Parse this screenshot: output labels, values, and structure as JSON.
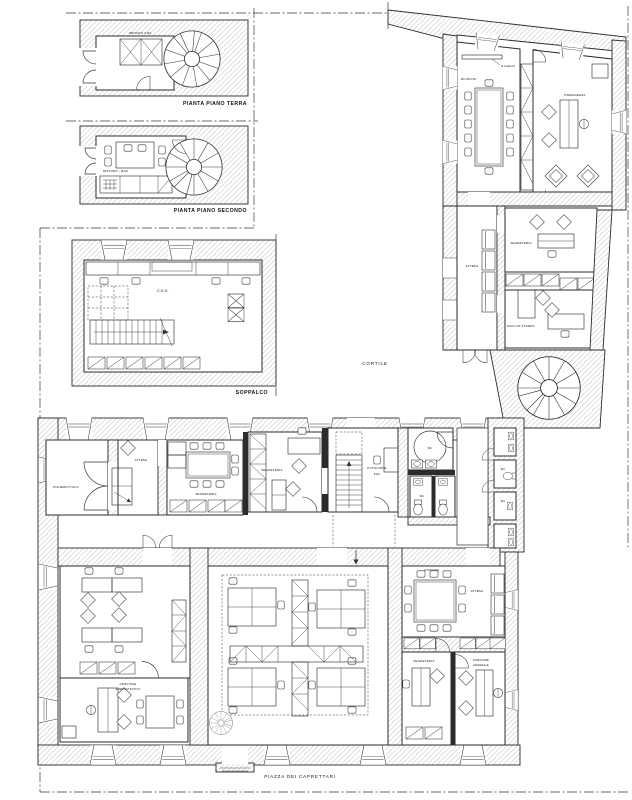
{
  "colors": {
    "ink": "#1a1a1a",
    "hatch_line": "#8d8d8d",
    "paper": "#ffffff"
  },
  "captions": {
    "piano_terra": "PIANTA PIANO TERRA",
    "piano_secondo": "PIANTA PIANO SECONDO",
    "soppalco": "SOPPALCO",
    "cortile": "CORTILE",
    "piazza": "PIAZZA DEI CAPRETTARI"
  },
  "rooms": {
    "impianti": "IMPIANTI CDZ",
    "ristoro": "RISTORO - BAR",
    "ced": "C.E.D.",
    "riunioni": "RIUNIONI",
    "presidenza": "PRESIDENZA",
    "armadietto": "armadietto",
    "attesa": "ATTESA",
    "segreteria": "SEGRETERIA",
    "ufficio_stampa": "UFFICIO STAMPA",
    "pianerottolo": "PIANEROTTOLO",
    "fotocopie_line1": "FOTOCOPIE",
    "fotocopie_line2": "FAX",
    "wc": "WC",
    "direttore_line1": "DIRETTORE",
    "direttore_line2": "AMMINISTRATIVO",
    "direzione_line1": "DIREZIONE",
    "direzione_line2": "GENERALE"
  }
}
